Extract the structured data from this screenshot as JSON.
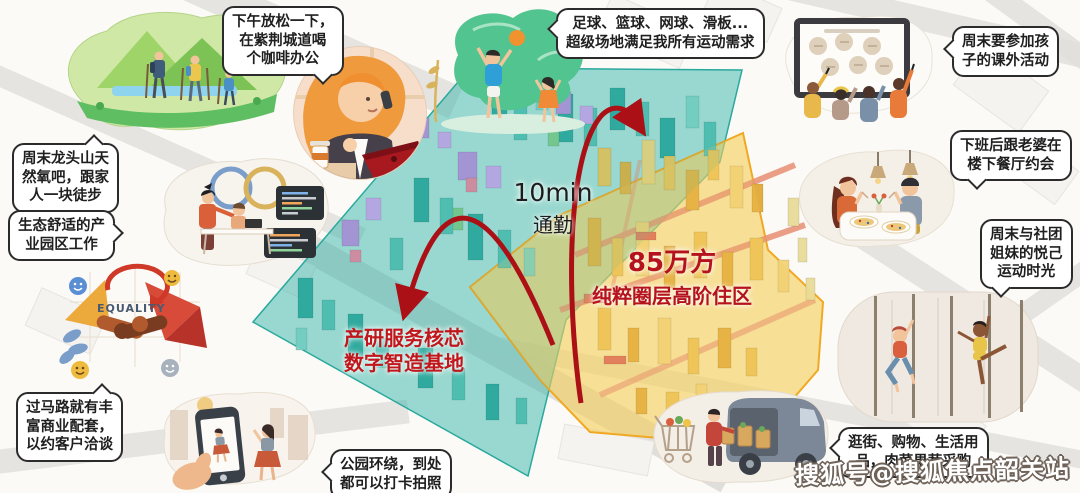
{
  "page": {
    "watermark": "搜狐号@搜狐焦点韶关站"
  },
  "map": {
    "commute": {
      "line1": "10min",
      "line2": "通勤"
    },
    "residential": {
      "line1": "85万方",
      "line2": "纯粹圈层高阶住区"
    },
    "industrial": {
      "line1": "产研服务核芯",
      "line2": "数字智造基地"
    },
    "colors": {
      "industrial_zone": "#35b5a9",
      "residential_zone": "#f6cf5e",
      "residential_border": "#f1a51d",
      "industrial_border": "#29a89c",
      "accent_red": "#b5121b",
      "arrow_red": "#ab1016"
    }
  },
  "bubbles": {
    "coffee": {
      "lines": [
        "下午放松一下，",
        "在紫荆城道喝",
        "个咖啡办公"
      ]
    },
    "hiking": {
      "lines": [
        "周末龙头山天",
        "然氧吧，跟家",
        "人一块徒步"
      ]
    },
    "industry_work": {
      "lines": [
        "生态舒适的产",
        "业园区工作"
      ]
    },
    "business": {
      "lines": [
        "过马路就有丰",
        "富商业配套，",
        "以约客户洽谈"
      ]
    },
    "sports": {
      "lines": [
        "足球、篮球、网球、滑板...",
        "超级场地满足我所有运动需求"
      ]
    },
    "kids": {
      "lines": [
        "周末要参加孩",
        "子的课外活动"
      ]
    },
    "dinner": {
      "lines": [
        "下班后跟老婆在",
        "楼下餐厅约会"
      ]
    },
    "sisters": {
      "lines": [
        "周末与社团",
        "姐妹的悦己",
        "运动时光"
      ]
    },
    "shopping": {
      "lines": [
        "逛街、购物、生活用",
        "品，肉菜果蔬采购"
      ]
    },
    "park": {
      "lines": [
        "公园环绕，到处",
        "都可以打卡拍照"
      ]
    }
  },
  "equality": {
    "label": "EQUALITY"
  },
  "illustrations": [
    "hiking-family-illustration",
    "coffee-laptop-woman-illustration",
    "coding-team-illustration",
    "equality-handshake-illustration",
    "photo-shoot-illustration",
    "ball-games-illustration",
    "kids-whiteboard-illustration",
    "restaurant-date-illustration",
    "pole-fitness-illustration",
    "grocery-van-illustration"
  ]
}
